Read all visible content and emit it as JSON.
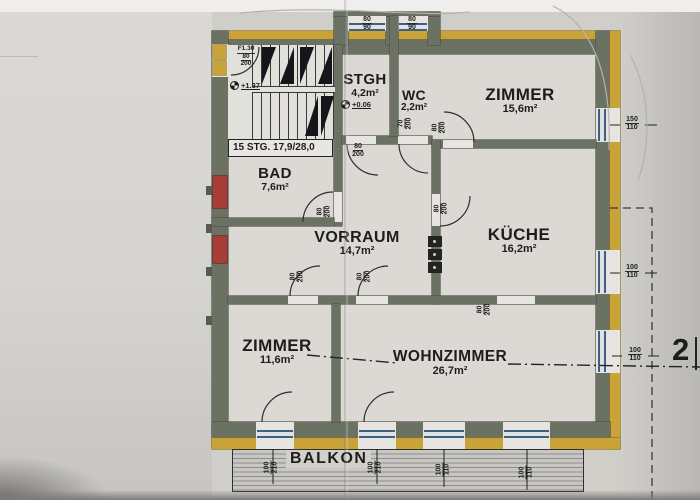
{
  "drawing": {
    "rooms": {
      "stgh": {
        "name": "STGH",
        "area": "4,2m²"
      },
      "wc": {
        "name": "WC",
        "area": "2,2m²"
      },
      "zimmer_ne": {
        "name": "ZIMMER",
        "area": "15,6m²"
      },
      "bad": {
        "name": "BAD",
        "area": "7,6m²"
      },
      "vorraum": {
        "name": "VORRAUM",
        "area": "14,7m²"
      },
      "kueche": {
        "name": "KÜCHE",
        "area": "16,2m²"
      },
      "zimmer_sw": {
        "name": "ZIMMER",
        "area": "11,6m²"
      },
      "wohnzimmer": {
        "name": "WOHNZIMMER",
        "area": "26,7m²"
      },
      "balkon": {
        "name": "BALKON"
      }
    },
    "stairs": {
      "note": "15 STG. 17,9/28,0"
    },
    "levels": {
      "stair": "+1.37",
      "stgh": "+0.06"
    },
    "entrance": {
      "fire_rating": "F1.30",
      "w": "80",
      "h": "200"
    },
    "dims": {
      "stgh_window": {
        "w": "80",
        "h": "90"
      },
      "wc_window": {
        "w": "80",
        "h": "90"
      },
      "zimmer_ne_window": {
        "w": "150",
        "h": "110"
      },
      "kueche_window": {
        "w": "100",
        "h": "110"
      },
      "wohnzimmer_window": {
        "w": "100",
        "h": "110"
      },
      "stgh_door": {
        "w": "80",
        "h": "200"
      },
      "wc_door": {
        "w": "70",
        "h": "200"
      },
      "zimmer_ne_door": {
        "w": "80",
        "h": "200"
      },
      "bad_door": {
        "w": "80",
        "h": "200"
      },
      "kueche_door": {
        "w": "80",
        "h": "200"
      },
      "zimmer_sw_door": {
        "w": "80",
        "h": "200"
      },
      "wohnzimmer_door": {
        "w": "80",
        "h": "200"
      },
      "kueche_opening": {
        "w": "80",
        "h": "200"
      },
      "balkon_door_1": {
        "w": "100",
        "h": "210"
      },
      "balkon_door_2": {
        "w": "100",
        "h": "210"
      },
      "balkon_window_1": {
        "w": "100",
        "h": "110"
      },
      "balkon_window_2": {
        "w": "100",
        "h": "110"
      }
    },
    "section": {
      "number": "2"
    },
    "colors": {
      "wall": "#6b7263",
      "insulation": "#c9a238",
      "window": "#3f6080",
      "chimney": "#a83c36"
    }
  }
}
